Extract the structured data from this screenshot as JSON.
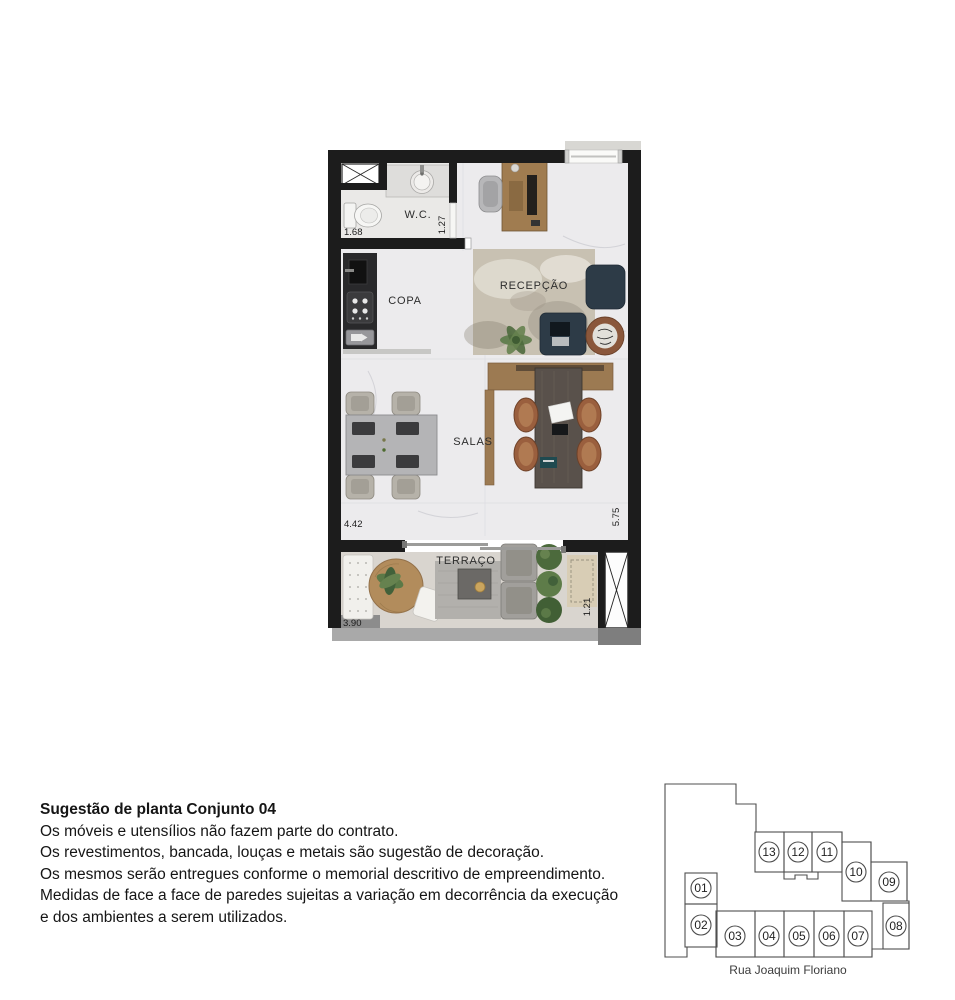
{
  "floor_plan": {
    "rooms": {
      "wc": "W.C.",
      "copa": "COPA",
      "recepcao": "RECEPÇÃO",
      "salas": "SALAS",
      "terraco": "TERRAÇO"
    },
    "dimensions": {
      "wc_width": "1.68",
      "wc_depth": "1.27",
      "salas_width": "4.42",
      "salas_depth": "5.75",
      "terraco_width": "3.90",
      "terraco_depth": "1.21"
    }
  },
  "notes": {
    "title": "Sugestão de planta Conjunto 04",
    "lines": [
      "Os móveis e utensílios não fazem parte do contrato.",
      "Os revestimentos, bancada, louças e metais são sugestão de decoração.",
      "Os mesmos serão entregues conforme o memorial descritivo de empreendimento.",
      "Medidas de face a face de paredes sujeitas a variação em decorrência da execução",
      "e dos ambientes a serem utilizados."
    ]
  },
  "key_plan": {
    "street": "Rua Joaquim Floriano",
    "highlighted_unit": "04",
    "units": [
      {
        "label": "01"
      },
      {
        "label": "02"
      },
      {
        "label": "03"
      },
      {
        "label": "04"
      },
      {
        "label": "05"
      },
      {
        "label": "06"
      },
      {
        "label": "07"
      },
      {
        "label": "08"
      },
      {
        "label": "09"
      },
      {
        "label": "10"
      },
      {
        "label": "11"
      },
      {
        "label": "12"
      },
      {
        "label": "13"
      }
    ]
  },
  "colors": {
    "wall": "#1c1c1c",
    "floor_marble": "#ecebed",
    "floor_terrace": "#d9d5cf",
    "counter_dark": "#29292b",
    "wood": "#9c7a52",
    "navy_chair": "#2d3b47",
    "rust_chair": "#9a5f3e",
    "key_plan_highlight": "#e3e3e3"
  }
}
